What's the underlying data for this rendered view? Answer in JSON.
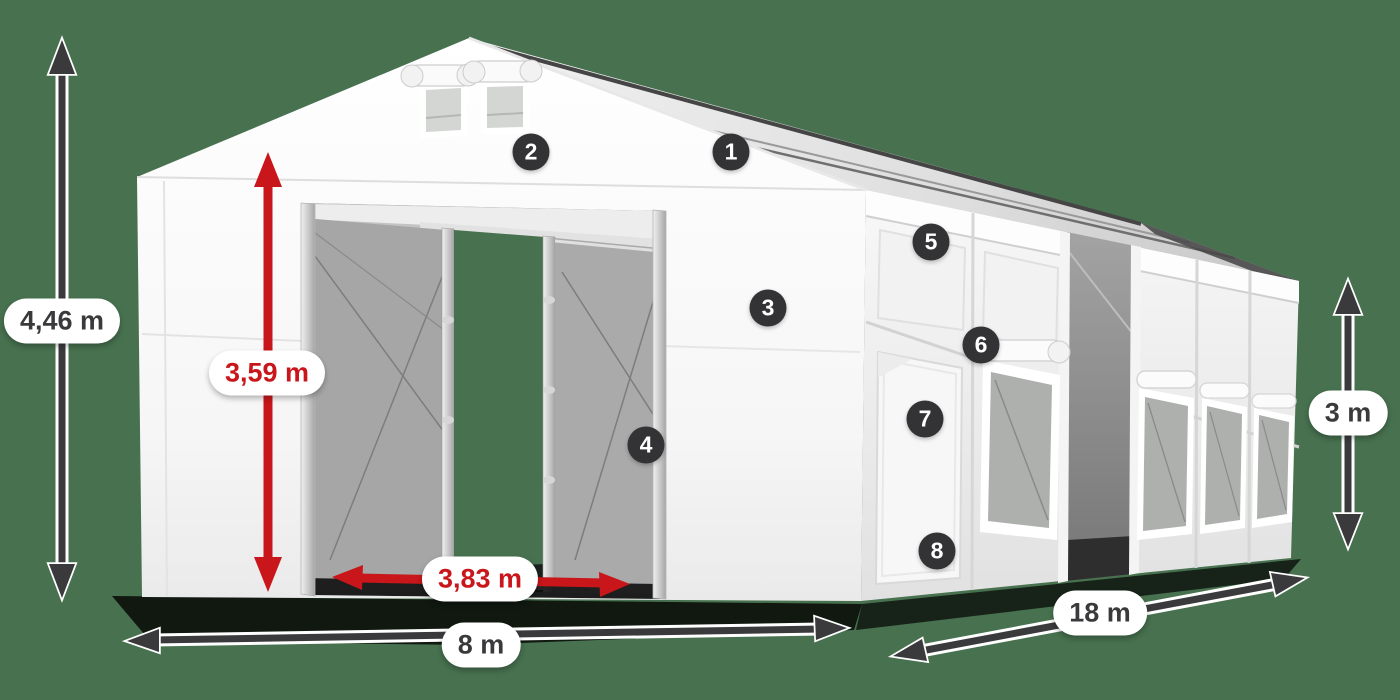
{
  "dimensions": {
    "total_height": "4,46 m",
    "door_height": "3,59 m",
    "door_width": "3,83 m",
    "front_width": "8 m",
    "length": "18 m",
    "side_wall_height": "3 m"
  },
  "feature_badges": [
    "1",
    "2",
    "3",
    "4",
    "5",
    "6",
    "7",
    "8"
  ],
  "colors": {
    "background": "#47714F",
    "arrow_dark": "#3A3A3C",
    "dimension_red": "#C8161A",
    "pill_bg": "#FFFFFF",
    "badge_bg": "#333335",
    "badge_text": "#FFFFFF"
  }
}
